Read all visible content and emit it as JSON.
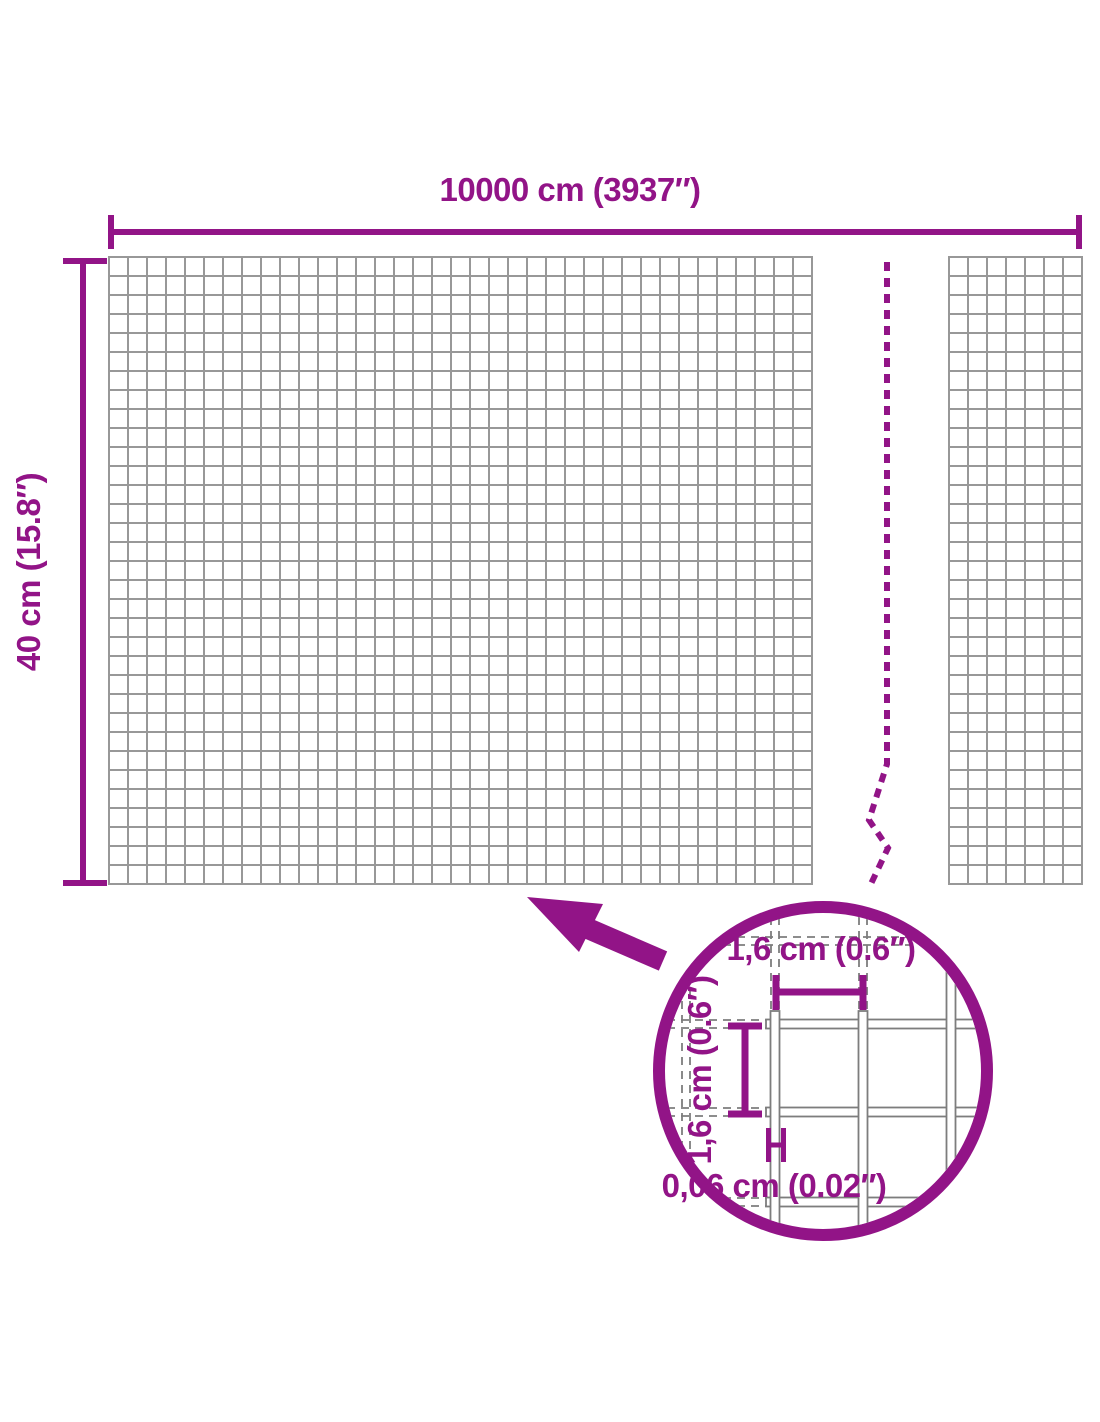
{
  "colors": {
    "accent": "#921487",
    "mesh_grid": "#989898",
    "wire_outline": "#7d7d7d",
    "background": "#ffffff"
  },
  "diagram": {
    "width_dimension": {
      "label": "10000 cm (3937″)"
    },
    "height_dimension": {
      "label": "40 cm (15.8″)"
    },
    "magnified_detail": {
      "mesh_opening_width": {
        "label": "1,6 cm (0.6″)"
      },
      "mesh_opening_height": {
        "label": "1,6 cm (0.6″)"
      },
      "wire_thickness": {
        "label": "0,06 cm (0.02″)"
      }
    }
  }
}
